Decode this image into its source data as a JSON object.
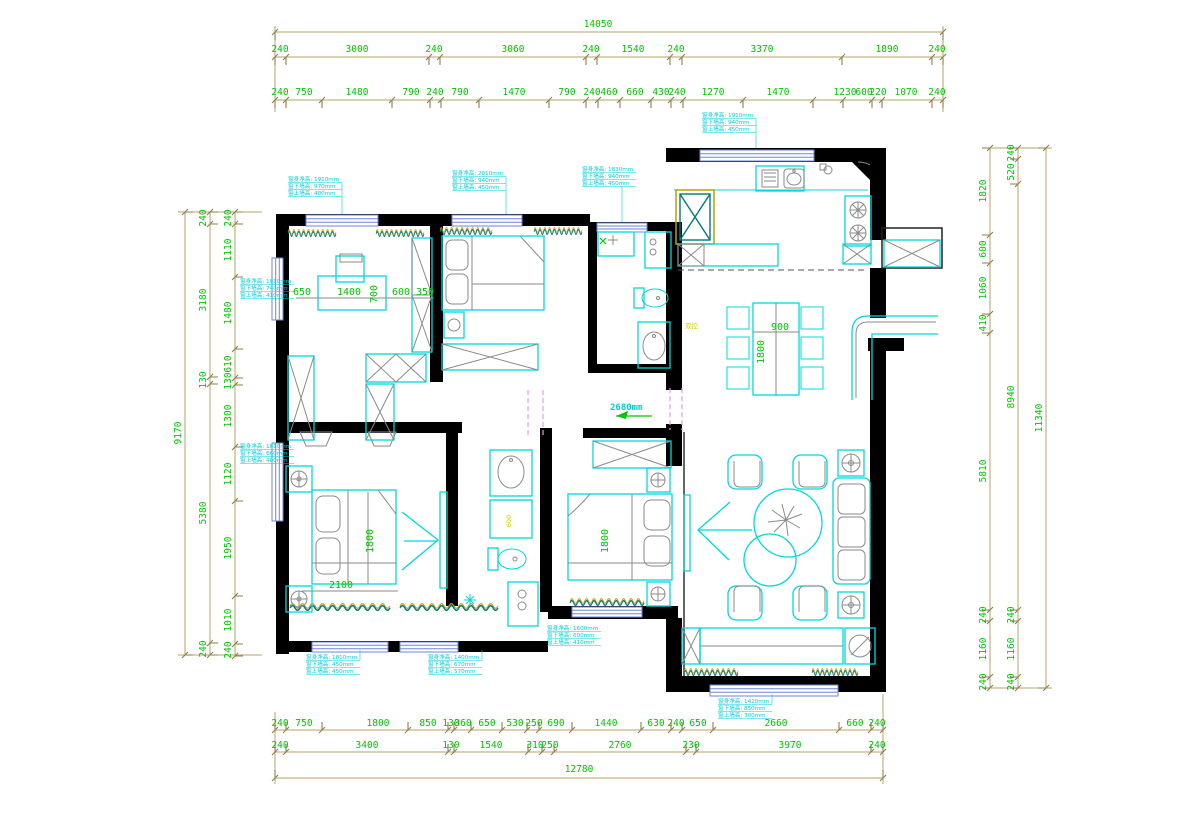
{
  "colors": {
    "dim_line": "#b5a36b",
    "dim_text": "#00c400",
    "wall": "#000000",
    "furniture": "#00d9d9",
    "window": "#6f86d8",
    "door_swing": "#eb9ed2",
    "annotation": "#00cdd6",
    "accent": "#cfcf00"
  },
  "dims": {
    "top": {
      "total": "14050",
      "row2": [
        "240",
        "3000",
        "240",
        "3060",
        "240",
        "1540",
        "240",
        "3370",
        "1890",
        "240"
      ],
      "row3": [
        "240",
        "750",
        "1480",
        "790",
        "240",
        "790",
        "1470",
        "790",
        "240",
        "460",
        "660",
        "430",
        "240",
        "1270",
        "1470",
        "1230",
        "600",
        "220",
        "1070",
        "240"
      ]
    },
    "bottom": {
      "total": "12780",
      "row1": [
        "240",
        "750",
        "1800",
        "850",
        "130",
        "360",
        "650",
        "530",
        "250",
        "690",
        "1440",
        "630",
        "240",
        "650",
        "2660",
        "660",
        "240"
      ],
      "row2": [
        "240",
        "3400",
        "130",
        "1540",
        "310",
        "250",
        "2760",
        "230",
        "3970",
        "240"
      ]
    },
    "left": {
      "total": "9170",
      "outer": [
        "240",
        "3180",
        "130",
        "5380",
        "240"
      ],
      "inner": [
        "240",
        "1110",
        "1480",
        "610",
        "130",
        "1300",
        "1120",
        "1950",
        "1010",
        "240"
      ]
    },
    "right": {
      "total": "11340",
      "inner": [
        "1820",
        "600",
        "1060",
        "410",
        "5810",
        "240",
        "1160",
        "240"
      ],
      "middle": [
        "240",
        "520",
        "8940",
        "240",
        "1160",
        "240"
      ]
    }
  },
  "labels": {
    "study": {
      "a": "650",
      "b": "1400",
      "c": "700",
      "d": "600",
      "e": "350"
    },
    "dining": {
      "w": "900",
      "l": "1800"
    },
    "master": {
      "w": "2100",
      "l": "1800"
    },
    "bedroom3": {
      "l": "1800"
    },
    "corridor": {
      "width": "2680mm"
    },
    "bath": {
      "depth": "600"
    },
    "switch": "双控"
  },
  "annots": [
    {
      "l1": "窗身净高: 1910mm",
      "l2": "窗下墙高: 970mm",
      "l3": "窗上墙高: 400mm"
    },
    {
      "l1": "窗身净高: 2010mm",
      "l2": "窗下墙高: 940mm",
      "l3": "窗上墙高: 450mm"
    },
    {
      "l1": "窗身净高: 1830mm",
      "l2": "窗下墙高: 940mm",
      "l3": "窗上墙高: 450mm"
    },
    {
      "l1": "窗身净高: 1910mm",
      "l2": "窗下墙高: 940mm",
      "l3": "窗上墙高: 450mm"
    },
    {
      "l1": "窗身净高: 1810mm",
      "l2": "窗下墙高: 740mm",
      "l3": "窗上墙高: 410mm"
    },
    {
      "l1": "窗身净高: 1810mm",
      "l2": "窗下墙高: 660mm",
      "l3": "窗上墙高: 400mm"
    },
    {
      "l1": "窗身净高: 1810mm",
      "l2": "窗下墙高: 450mm",
      "l3": "窗上墙高: 450mm"
    },
    {
      "l1": "窗身净高: 1400mm",
      "l2": "窗下墙高: 670mm",
      "l3": "窗上墙高: 570mm"
    },
    {
      "l1": "窗身净高: 1600mm",
      "l2": "窗下墙高: 600mm",
      "l3": "窗上墙高: 410mm"
    },
    {
      "l1": "窗身净高: 1420mm",
      "l2": "窗下墙高: 850mm",
      "l3": "窗上墙高: 300mm"
    }
  ]
}
